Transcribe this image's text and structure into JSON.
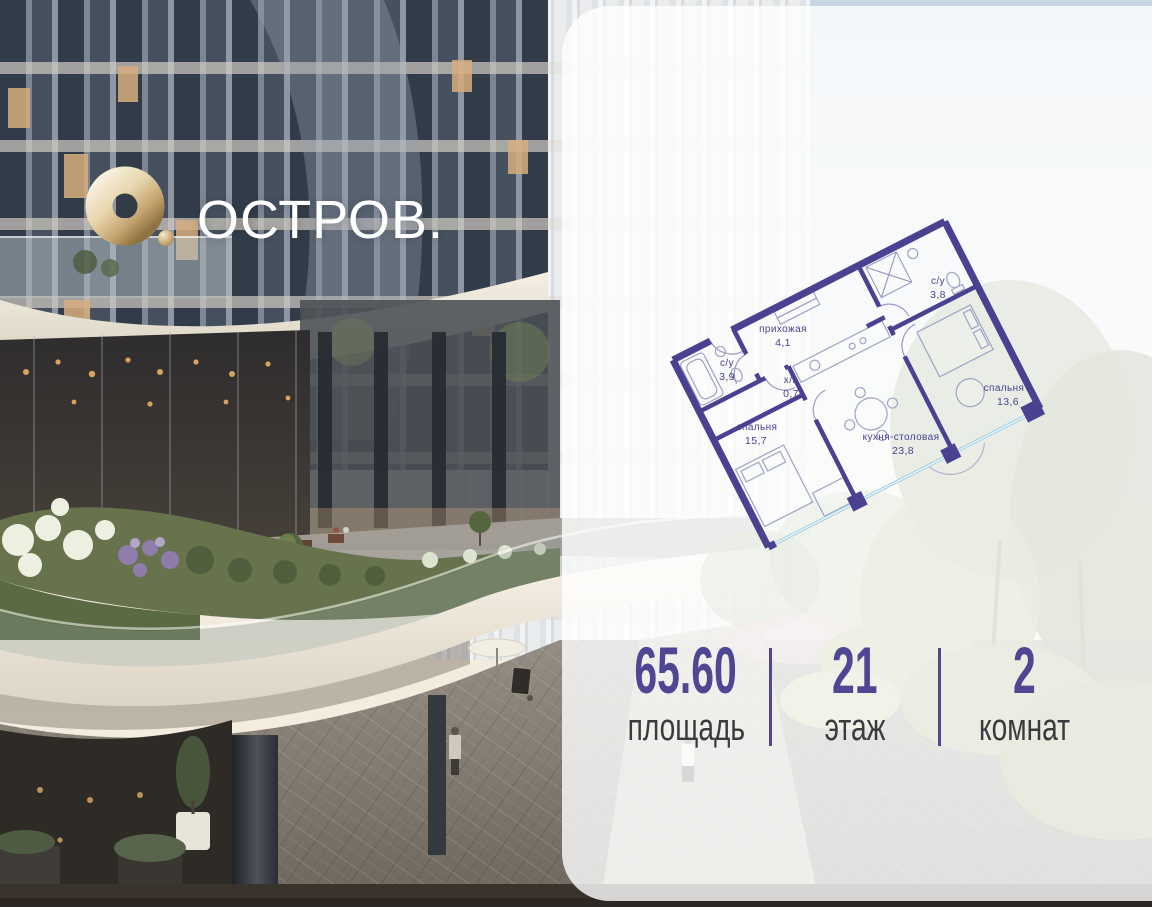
{
  "logo": {
    "brand": "ОСТРОВ.",
    "mark_color": "#cfae76"
  },
  "floor_plan": {
    "rotation_deg": -27,
    "wall_color": "#4a4190",
    "glazing_color": "#a4d2e6",
    "label_color": "#4a4190",
    "rooms": [
      {
        "name": "прихожая",
        "area": "4,1"
      },
      {
        "name": "с/у",
        "area": "3,8"
      },
      {
        "name": "с/у",
        "area": "3,9"
      },
      {
        "name": "х/п",
        "area": "0,7"
      },
      {
        "name": "спальня",
        "area": "15,7"
      },
      {
        "name": "спальня",
        "area": "13,6"
      },
      {
        "name": "кухня-столовая",
        "area": "23,8"
      }
    ]
  },
  "stats": {
    "accent_color": "#4f4794",
    "label_color": "#3b3a3c",
    "items": [
      {
        "value": "65.60",
        "label": "площадь"
      },
      {
        "value": "21",
        "label": "этаж"
      },
      {
        "value": "2",
        "label": "комнат"
      }
    ]
  }
}
